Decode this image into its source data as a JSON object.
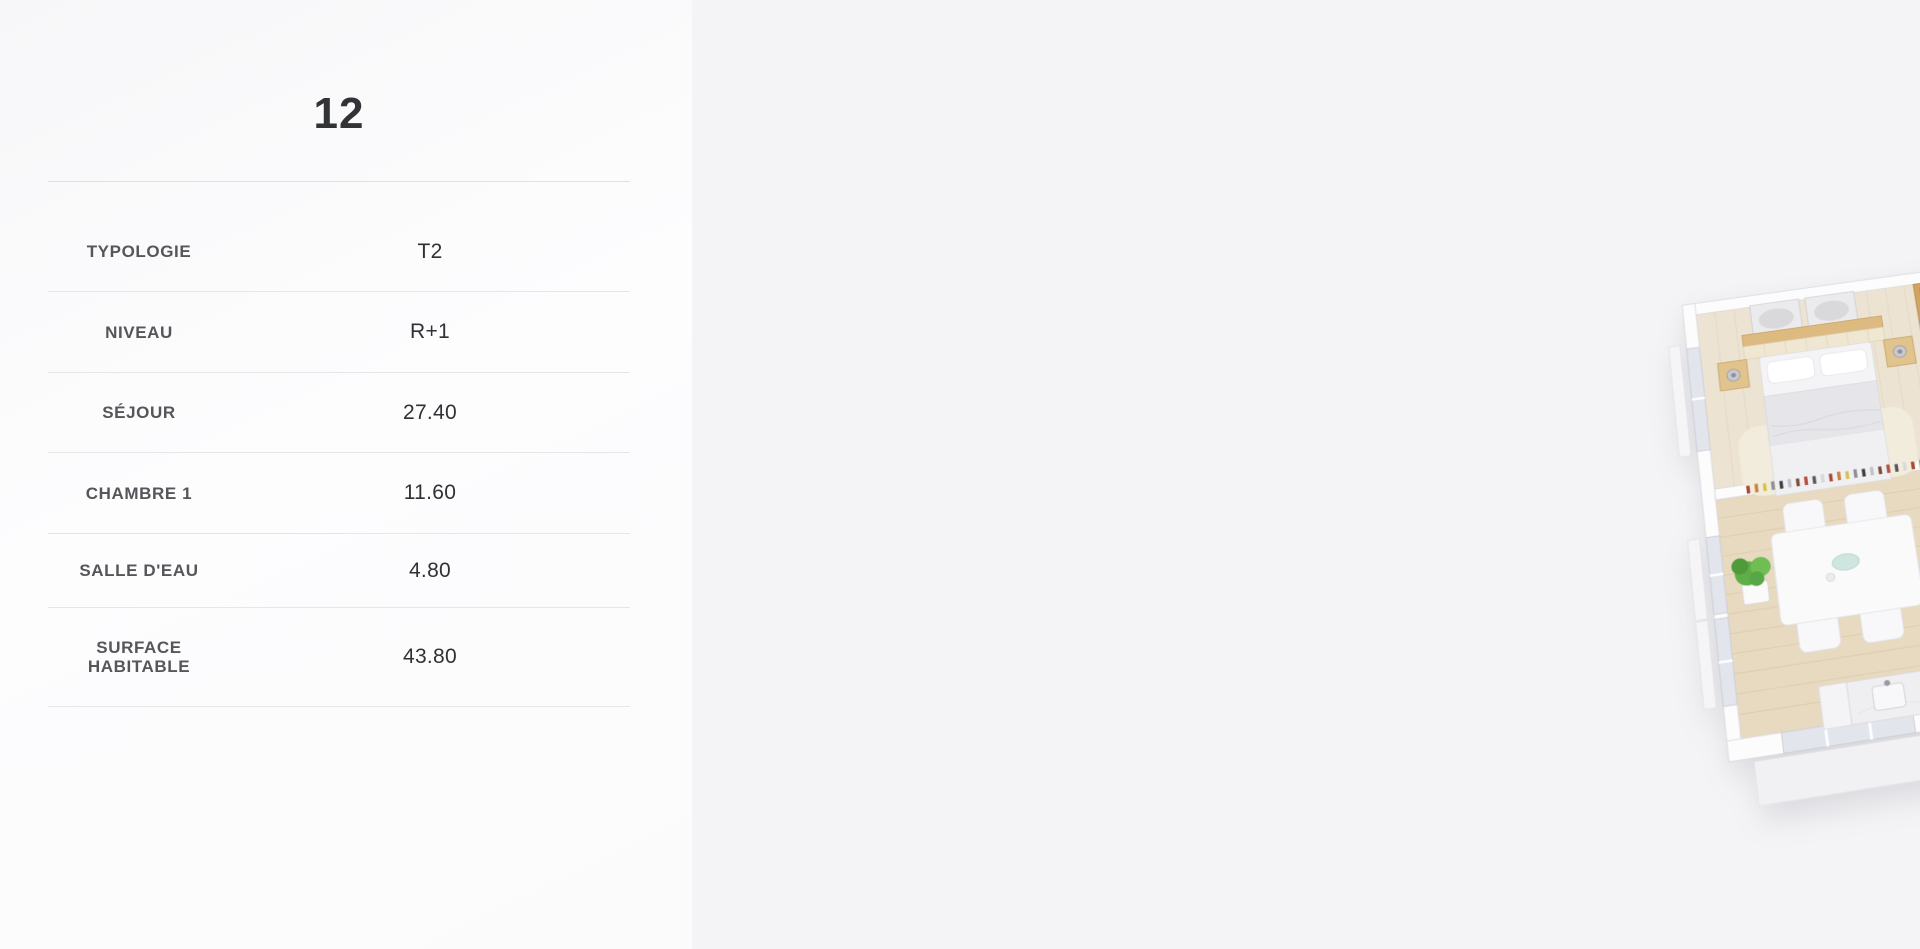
{
  "details_panel": {
    "title": "12",
    "rows": [
      {
        "label": "TYPOLOGIE",
        "value": "T2"
      },
      {
        "label": "NIVEAU",
        "value": "R+1"
      },
      {
        "label": "SÉJOUR",
        "value": "27.40"
      },
      {
        "label": "CHAMBRE 1",
        "value": "11.60"
      },
      {
        "label": "SALLE D'EAU",
        "value": "4.80"
      },
      {
        "label": "SURFACE HABITABLE",
        "value": "43.80"
      }
    ]
  },
  "viewer": {
    "close_icon": "✕"
  },
  "colors": {
    "left_panel_bg": "#fcfcfd",
    "canvas_bg": "#f4f4f6",
    "title_divider_accent": "#eadfd3",
    "row_divider": "#e6e6e9",
    "close_button_bg": "#a9a9ad",
    "close_icon_color": "#ffffff",
    "wood_floor": "#e8dac1",
    "bedroom_floor": "#ece3d3",
    "bath_tile": "#9c9c9f",
    "shower_tile": "#4a4a51",
    "wardrobe_wood": "#d2a462",
    "stairs_wood": "#d9ae6b",
    "rug_gray": "#ababaf",
    "water_heater_label": "#ce4337"
  }
}
